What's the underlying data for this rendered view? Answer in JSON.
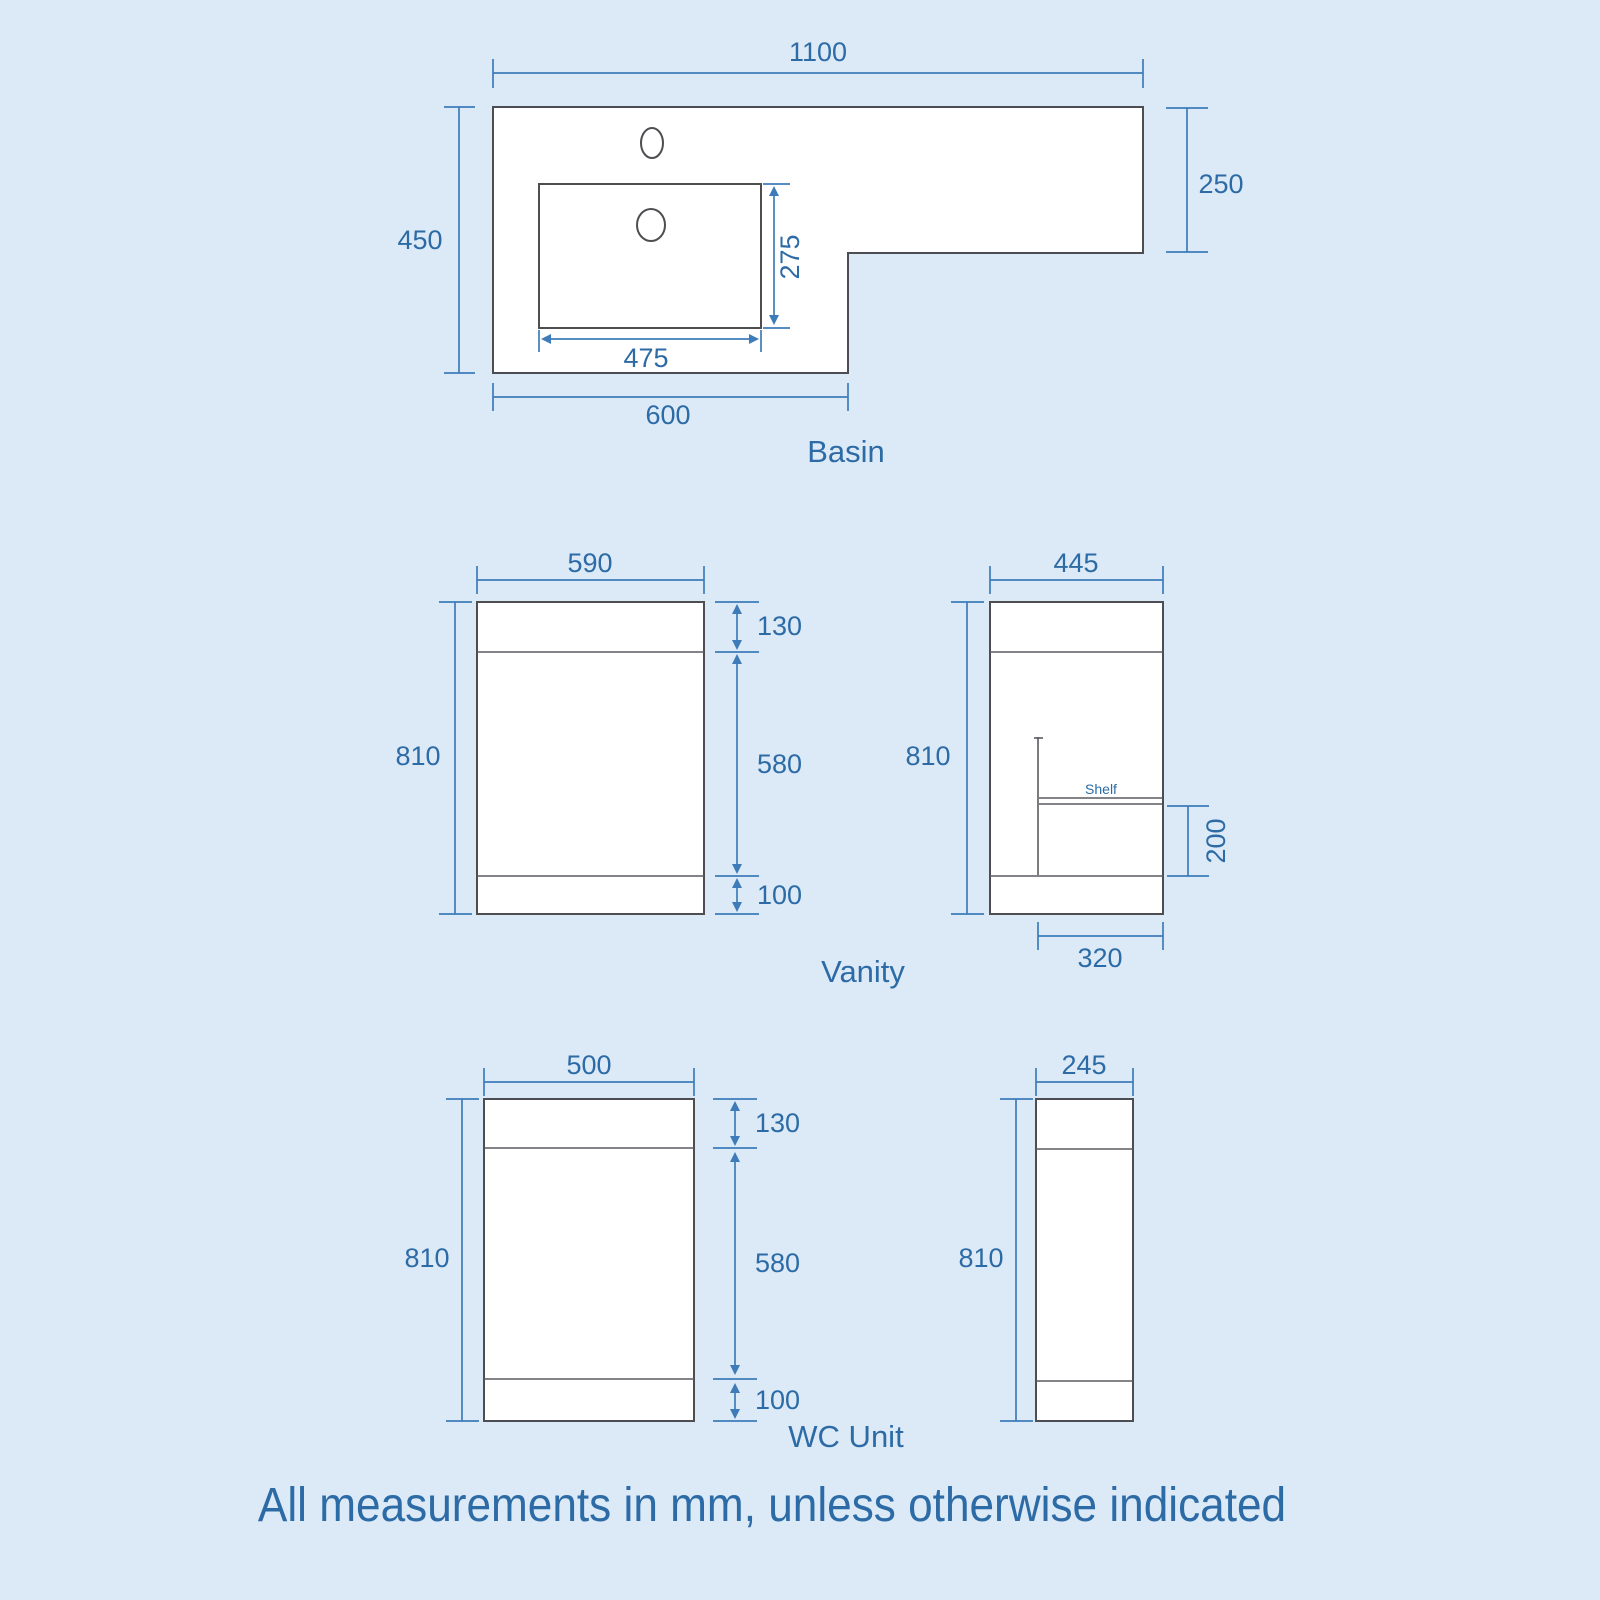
{
  "note": "All measurements in mm, unless otherwise indicated",
  "colors": {
    "background": "#dce9f7",
    "dimension_line": "#3d7cb8",
    "dimension_text": "#2c6ba5",
    "outline": "#4d4d52",
    "shape_fill": "#ffffff"
  },
  "basin": {
    "label": "Basin",
    "top_width": "1100",
    "left_height": "450",
    "right_height": "250",
    "bowl_width": "475",
    "bowl_depth": "275",
    "left_width": "600"
  },
  "vanity": {
    "label": "Vanity",
    "front": {
      "width": "590",
      "height": "810",
      "top": "130",
      "middle": "580",
      "bottom": "100"
    },
    "side": {
      "depth": "445",
      "height": "810",
      "shelf_label": "Shelf",
      "shelf_height": "200",
      "shelf_depth": "320"
    }
  },
  "wc": {
    "label": "WC Unit",
    "front": {
      "width": "500",
      "height": "810",
      "top": "130",
      "middle": "580",
      "bottom": "100"
    },
    "side": {
      "depth": "245",
      "height": "810"
    }
  }
}
